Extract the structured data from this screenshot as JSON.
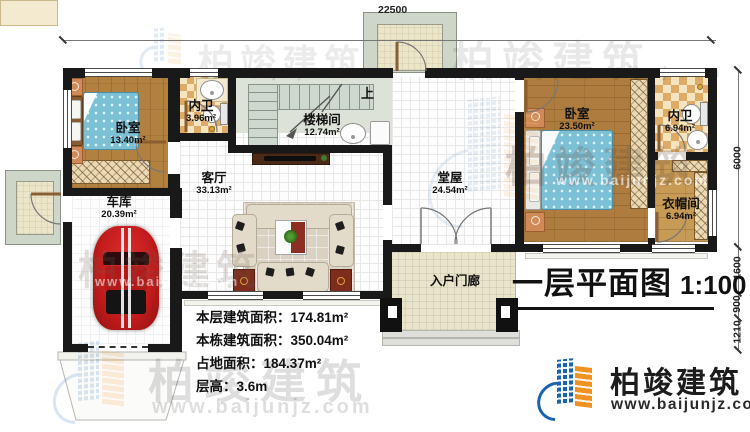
{
  "title": {
    "text": "一层平面图",
    "scale": "1:100"
  },
  "dims": {
    "top": "22500",
    "right": [
      "6000",
      "1600",
      "900",
      "1210"
    ]
  },
  "rooms": {
    "bedroom1": {
      "name": "卧室",
      "area": "13.40m²"
    },
    "bath1": {
      "name": "内卫",
      "area": "3.96m²"
    },
    "stairwell": {
      "name": "楼梯间",
      "area": "12.74m²",
      "up": "上"
    },
    "living": {
      "name": "客厅",
      "area": "33.13m²"
    },
    "hall": {
      "name": "堂屋",
      "area": "24.54m²"
    },
    "bedroom2": {
      "name": "卧室",
      "area": "23.50m²"
    },
    "bath2": {
      "name": "内卫",
      "area": "6.94m²"
    },
    "closet": {
      "name": "衣帽间",
      "area": "6.94m²"
    },
    "garage": {
      "name": "车库",
      "area": "20.39m²"
    },
    "porch": {
      "name": "入户门廊"
    }
  },
  "info": {
    "l1": "本层建筑面积：",
    "v1": "174.81m²",
    "l2": "本栋建筑面积：",
    "v2": "350.04m²",
    "l3": "占地面积：",
    "v3": "184.37m²",
    "l4": "层高：",
    "v4": "3.6m"
  },
  "brand": {
    "name": "柏竣建筑",
    "website": "www.baijunjz.com"
  },
  "colors": {
    "wall": "#191919",
    "wood": "#b3813f",
    "bed": "#7cc0d6",
    "car": "#c11b1b",
    "brand_blue": "#1b63b0",
    "brand_orange": "#ef9221"
  }
}
